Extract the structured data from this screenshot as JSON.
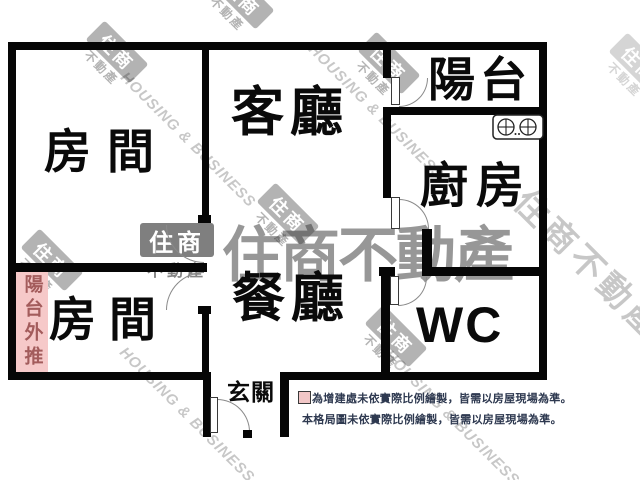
{
  "floorplan": {
    "rooms": {
      "bedroom_top": {
        "label": "房間"
      },
      "bedroom_bottom": {
        "label": "房間"
      },
      "living_room": {
        "label": "客廳"
      },
      "dining_room": {
        "label": "餐廳"
      },
      "balcony": {
        "label": "陽台"
      },
      "kitchen": {
        "label": "廚房"
      },
      "wc": {
        "label": "WC"
      },
      "entry": {
        "label": "玄關"
      },
      "balcony_extension": {
        "label": "陽台外推"
      }
    },
    "legend": {
      "note_annex": "為增建處未依實際比例繪製，皆需以房屋現場為準。",
      "note_layout": "本格局圖未依實際比例繪製，皆需以房屋現場為準。"
    },
    "watermark": {
      "brand": "住商不動產",
      "brand_en": "HOUSING & BUSINESS",
      "logo_top": "住商",
      "logo_bottom": "不動產"
    },
    "colors": {
      "wall": "#060606",
      "annex_pink": "#f6c9c9",
      "annex_text": "#a35c5c",
      "note_text": "#2e3950",
      "legend_square": "#f2c7c7"
    }
  }
}
